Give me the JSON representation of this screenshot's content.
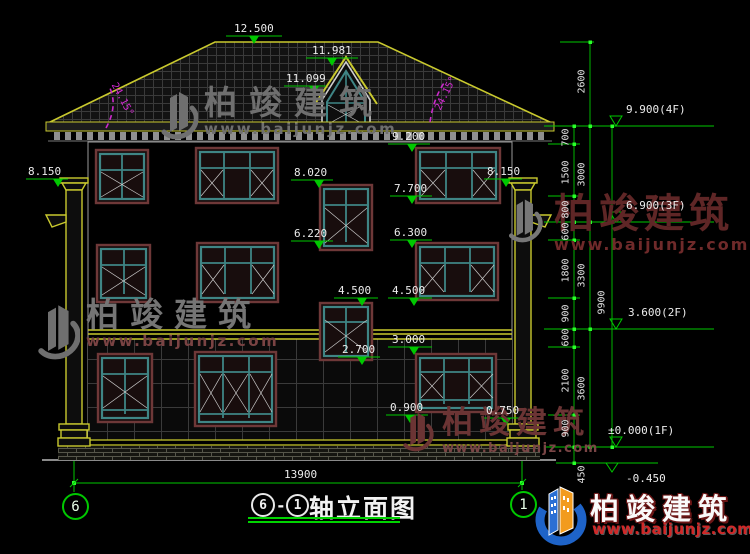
{
  "levels": {
    "l12500": "12.500",
    "l11981": "11.981",
    "l11099": "11.099",
    "l9200": "9.200",
    "l8150_left": "8.150",
    "l8150_right": "8.150",
    "l8020": "8.020",
    "l7700": "7.700",
    "l6220": "6.220",
    "l6300": "6.300",
    "l4500_left": "4.500",
    "l4500_right": "4.500",
    "l3000": "3.000",
    "l2700": "2.700",
    "l0900": "0.900",
    "l0750": "0.750"
  },
  "angles": {
    "left": "24.15°",
    "right": "24.15°"
  },
  "floors": {
    "f4": "9.900(4F)",
    "f3": "6.900(3F)",
    "f2": "3.600(2F)",
    "f1": "±0.000(1F)",
    "foundation": "-0.450"
  },
  "dims": {
    "v_fine": [
      "700",
      "1500",
      "800",
      "600",
      "1800",
      "900",
      "600",
      "2100",
      "900",
      "450"
    ],
    "v_mid": [
      "2600",
      "3000",
      "3300",
      "3600"
    ],
    "v_total": "9900",
    "h_total": "13900"
  },
  "title_block": {
    "circle_a": "6",
    "separator": "-",
    "circle_b": "1",
    "name": "轴立面图"
  },
  "axes": {
    "left": "6",
    "right": "1"
  },
  "brand": {
    "name": "柏竣建筑",
    "url": "www.baijunjz.com"
  },
  "watermark": {
    "name": "柏竣建筑",
    "url": "www.baijunjz.com"
  },
  "colors": {
    "dim_green": "#00c800",
    "outline_yellow": "#c9c92e",
    "frame_teal": "#3f8585",
    "surround_maroon": "#6e3838",
    "angle_magenta": "#cc2acc",
    "brand_blue": "#1e63c8",
    "brand_orange": "#f29b1d",
    "url_red": "#d02828"
  }
}
